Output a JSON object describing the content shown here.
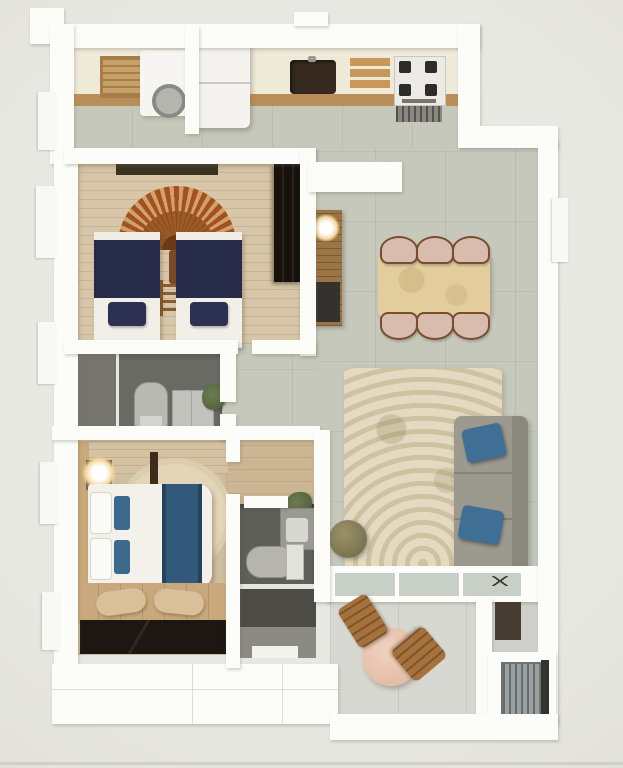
{
  "figure": {
    "title": "3D apartment floor plan, top-down render",
    "type": "floor-plan"
  },
  "palette": {
    "background": "#e9e9e4",
    "wall_white": "#fcfcf9",
    "tile_floor": "#c5c8bb",
    "wood_floor": "#c9a87d",
    "brick_wall": "#d8c6a8",
    "navy_bedding": "#262b49",
    "rust_decor": "#a3521f",
    "dining_table_tan": "#e4cd9d",
    "sofa_gray": "#9c998f",
    "pillow_blue": "#3f6f94",
    "rug_beige": "#ded3ba",
    "balcony_table_pink": "#e8c4af",
    "dark_wardrobe": "#17110c",
    "bathroom_floor_dark": "#5f5f5a",
    "accent_orange": "#e07a1e",
    "chair_wood": "#a5713d"
  },
  "rooms": [
    {
      "name": "Kitchen",
      "furniture": [
        "counter",
        "cutting tray",
        "washing machine",
        "refrigerator",
        "sink",
        "cutting boards",
        "gas stove",
        "oven"
      ]
    },
    {
      "name": "Twin Bedroom",
      "furniture": [
        "ceiling beam",
        "sunburst wall decor",
        "twin bed left",
        "twin bed right",
        "ladder shelf",
        "dark wardrobe"
      ]
    },
    {
      "name": "Dining Area",
      "furniture": [
        "half wall console",
        "flower bowl",
        "wood shelf with lamp",
        "dining table",
        "six chairs"
      ]
    },
    {
      "name": "Living Area",
      "furniture": [
        "area rug",
        "gray sofa",
        "two blue pillows",
        "pouf"
      ]
    },
    {
      "name": "Bathroom 1",
      "furniture": [
        "shower area",
        "toilet",
        "vanity cabinet",
        "plant"
      ]
    },
    {
      "name": "Master Bedroom",
      "furniture": [
        "lamp",
        "double bed with blue runner",
        "oval rug",
        "benches",
        "wood floor",
        "dark dresser"
      ]
    },
    {
      "name": "Bathroom 2",
      "furniture": [
        "vanity with plant",
        "toilet",
        "shower section"
      ]
    },
    {
      "name": "Balcony",
      "furniture": [
        "sliding glass door",
        "round table",
        "two wooden chairs"
      ]
    },
    {
      "name": "Utility Corner",
      "furniture": [
        "doorway",
        "air-conditioner unit"
      ]
    }
  ]
}
